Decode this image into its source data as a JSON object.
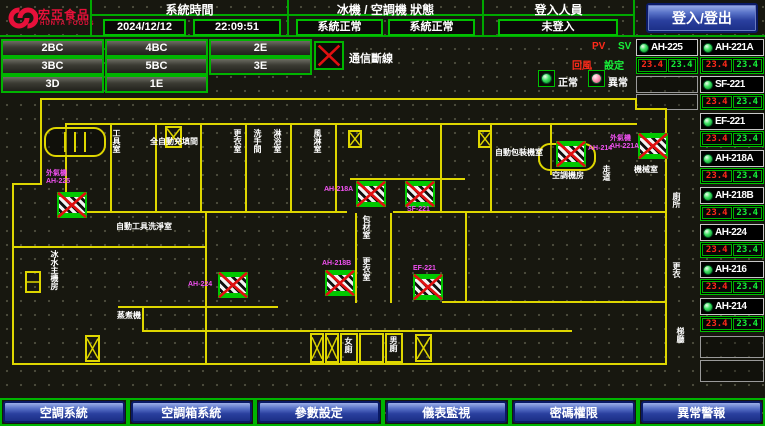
{
  "header": {
    "brand": "宏亞食品",
    "brand_en": "HUNYA FOODS",
    "system_time_label": "系統時間",
    "date": "2024/12/12",
    "time": "22:09:51",
    "status_label": "冰機 / 空調機 狀態",
    "chiller_status": "系統正常",
    "ahu_status": "系統正常",
    "login_label": "登入人員",
    "login_user": "未登入",
    "login_button": "登入/登出"
  },
  "floor_buttons": [
    "2BC",
    "4BC",
    "2E",
    "3BC",
    "5BC",
    "3E",
    "3D",
    "1E"
  ],
  "comm_loss_label": "通信斷線",
  "legend": {
    "pv": "PV",
    "sv": "SV",
    "row_pv": "回風",
    "row_sv": "設定",
    "normal": "正常",
    "abnormal": "異常"
  },
  "equipment": {
    "units": [
      {
        "name": "AH-225",
        "pv": "23.4",
        "sv": "23.4"
      },
      {
        "name": "AH-221A",
        "pv": "23.4",
        "sv": "23.4"
      },
      {
        "name": "SF-221",
        "pv": "23.4",
        "sv": "23.4"
      },
      {
        "name": "EF-221",
        "pv": "23.4",
        "sv": "23.4"
      },
      {
        "name": "AH-218A",
        "pv": "23.4",
        "sv": "23.4"
      },
      {
        "name": "AH-218B",
        "pv": "23.4",
        "sv": "23.4"
      },
      {
        "name": "AH-224",
        "pv": "23.4",
        "sv": "23.4"
      },
      {
        "name": "AH-216",
        "pv": "23.4",
        "sv": "23.4"
      },
      {
        "name": "AH-214",
        "pv": "23.4",
        "sv": "23.4"
      }
    ]
  },
  "plan": {
    "rooms": [
      "工具室",
      "全自動充填間",
      "自動工具洗淨室",
      "冰水主機房",
      "蒸煮機",
      "包材室",
      "更衣室",
      "女廁",
      "男廁",
      "自動包裝機室",
      "空調機房",
      "機械室",
      "廁所",
      "更衣",
      "梯廳",
      "走道",
      "更衣室",
      "洗手間",
      "淋浴室",
      "風淋室"
    ],
    "units": [
      "外氣機\nAH-225",
      "AH-224",
      "AH-218B",
      "AH-218A",
      "SF-221",
      "EF-221",
      "AH-214",
      "外氣機\nAH-221A"
    ]
  },
  "nav": [
    "空調系統",
    "空調箱系統",
    "參數設定",
    "儀表監視",
    "密碼權限",
    "異常警報"
  ]
}
